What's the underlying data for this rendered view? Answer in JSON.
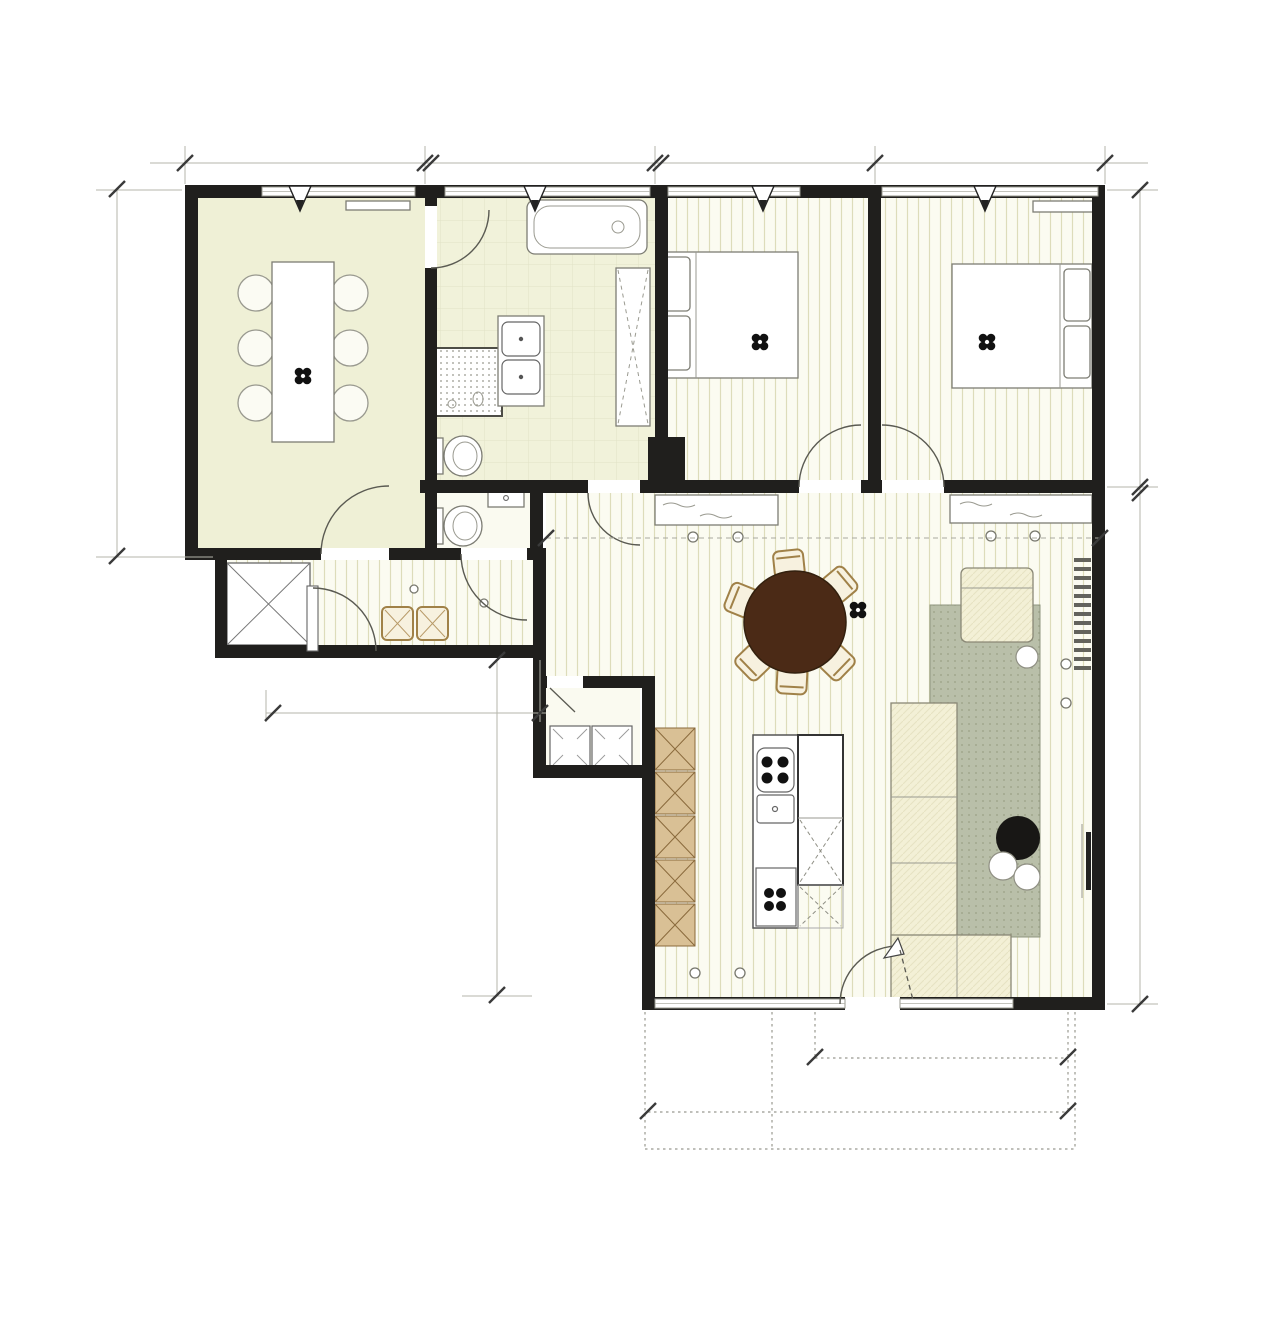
{
  "project": {
    "line1": "LOKERENBAAN 102 W1",
    "line2": "9240 ZELE",
    "line3": "SCHAAL 1/100",
    "line4": "VARIANTE 1"
  },
  "rooms": {
    "bureau": "BUREAU/ KAMER 3",
    "badkamer": "BADKAMER",
    "kamer2": "KAMER 2",
    "kamer1": "KAMER 1",
    "hall_line1": "WACHTRUIMTE/",
    "hall_line2": "HALL",
    "keuken": "KEUKEN",
    "zitruimte": "ZITRUIMTE",
    "electr": "ELECTR",
    "was": "WAS",
    "droog": "DROOG",
    "cv": "CV",
    "tv": "TV"
  },
  "dims": {
    "top": [
      "338",
      "320",
      "309",
      "328"
    ],
    "left": "521",
    "right_upper": "417",
    "right_lower": "747",
    "living": "807",
    "passage": "122",
    "hall": "374",
    "lower": "472",
    "terrace_door": "387,5",
    "terrace": "658"
  },
  "notes": {
    "raam1": "hoogte onder raam",
    "raam2": "93cm",
    "ceiling1": "hoogte RUIMTES",
    "ceiling2": "307cm"
  },
  "colors": {
    "wall": "#201f1d",
    "bureau_floor": "#eff0d6",
    "cabinet_tan": "#d9c095",
    "table_brown": "#4b2a16",
    "rug": "#b9bfa9",
    "cream": "#f3f0d6"
  }
}
